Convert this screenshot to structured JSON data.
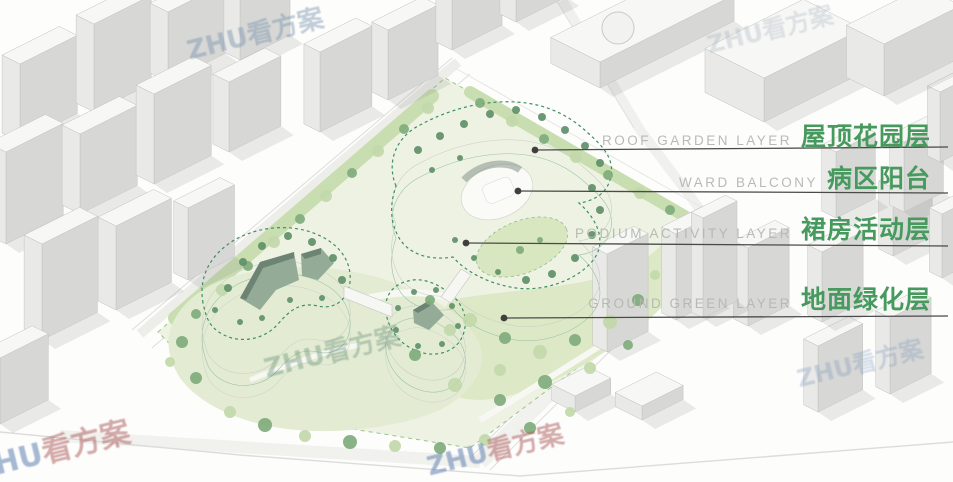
{
  "annotations": {
    "labels": [
      {
        "en": "ROOF GARDEN LAYER",
        "zh": "屋顶花园层"
      },
      {
        "en": "WARD BALCONY",
        "zh": "病区阳台"
      },
      {
        "en": "PODIUM ACTIVITY LAYER",
        "zh": "裙房活动层"
      },
      {
        "en": "GROUND GREEN LAYER",
        "zh": "地面绿化层"
      }
    ],
    "en_color": "#b5b8b0",
    "zh_color": "#479a5e",
    "leader_line_color": "#4a4a4a"
  },
  "watermark": {
    "brand": "ZHU",
    "suffix": "看方案"
  },
  "palette": {
    "roof_mint": "#a6cdb4",
    "roof_mint_band": "#b9d7c2",
    "dashed_outline_green": "#3f8e63",
    "lawn": "#dde9c6",
    "site_ground": "#eef2e3",
    "hedge": "#c9deb0",
    "tree_dark": "#7fab7c",
    "tree_light": "#c2d8aa",
    "tree_roof": "#5f9069",
    "building_white": "#f7f7f5",
    "facade_shade": "#d7d7d5",
    "facade_mid": "#e9e9e7",
    "courtyard": "#93ab97"
  }
}
